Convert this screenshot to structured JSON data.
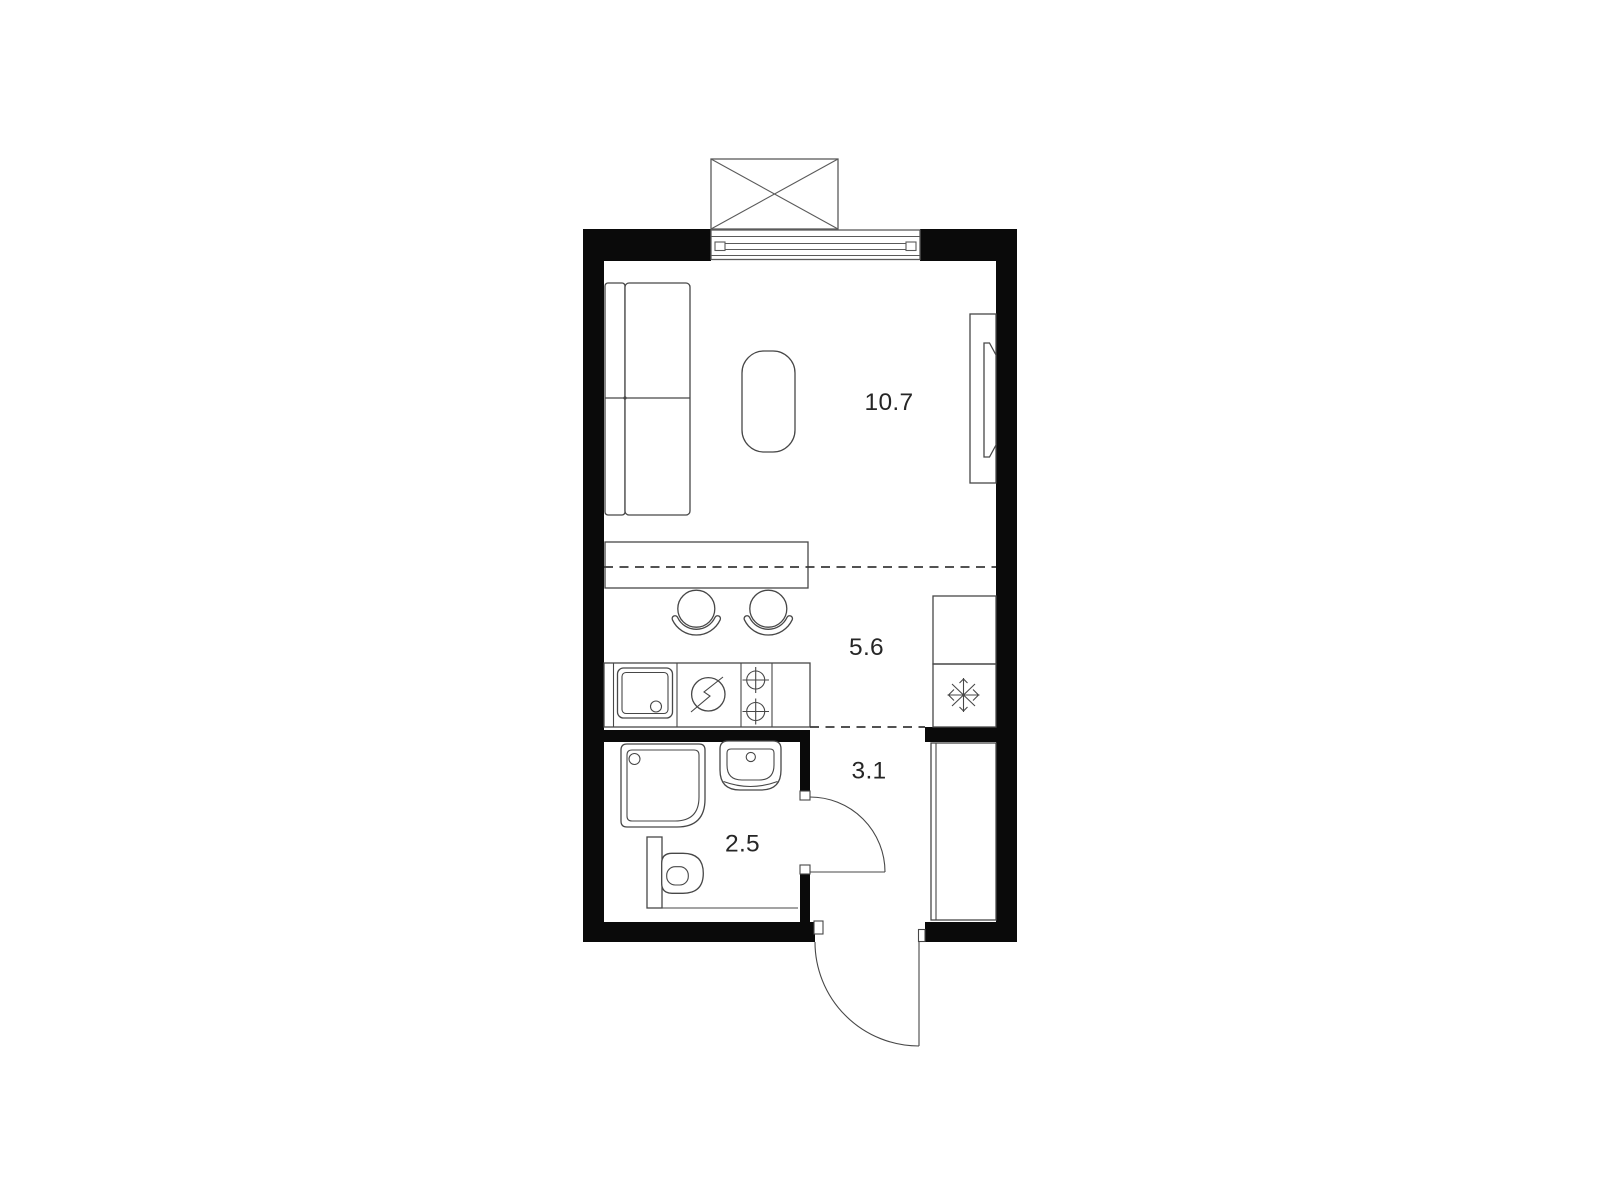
{
  "page": {
    "background": "#ffffff",
    "type": "apartment-floor-plan"
  },
  "colors": {
    "wall": "#0a0a0a",
    "line": "#474747",
    "line_soft": "#5a5a5a",
    "dash": "#3a3a3a",
    "text": "#262626",
    "fill": "#ffffff"
  },
  "rooms": {
    "living": {
      "label": "10.7"
    },
    "kitchen": {
      "label": "5.6"
    },
    "hallway": {
      "label": "3.1"
    },
    "bathroom": {
      "label": "2.5"
    }
  },
  "icons": {
    "freezer": "snowflake-icon",
    "stove": "lightning-circle-icon",
    "hob": "crosshair-burner-icon",
    "balcony": "crossed-box-icon",
    "door_swing": "quarter-arc-icon"
  }
}
